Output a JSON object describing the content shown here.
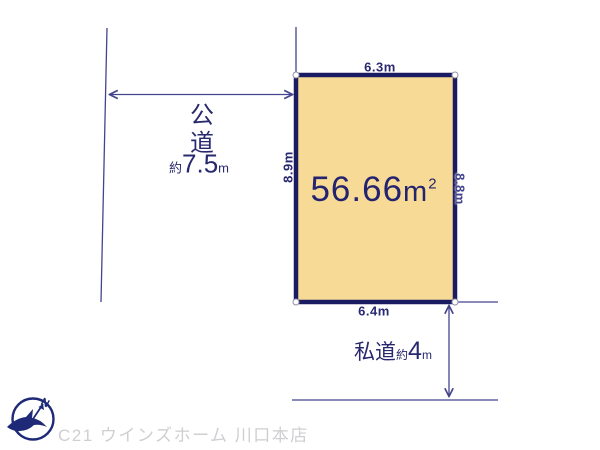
{
  "diagram": {
    "area": {
      "value": "56.66",
      "unit": "m",
      "sup": "2"
    },
    "dimensions": {
      "top": "6.3m",
      "bottom": "6.4m",
      "left": "8.9m",
      "right": "8.8m"
    },
    "public_road": {
      "name_char1": "公",
      "name_char2": "道",
      "approx": "約",
      "width_value": "7.5",
      "width_unit": "m"
    },
    "private_road": {
      "name": "私道",
      "approx": "約",
      "width_value": "4",
      "width_unit": "m"
    },
    "compass": {
      "north_label": "N"
    }
  },
  "footer": {
    "company": "C21 ウインズホーム 川口本店"
  },
  "colors": {
    "plot_fill": "#F6DA96",
    "plot_border": "#1B1B62",
    "dimension_line": "#44448E",
    "text": "#28286E",
    "footer_text": "#CFCFD3"
  }
}
